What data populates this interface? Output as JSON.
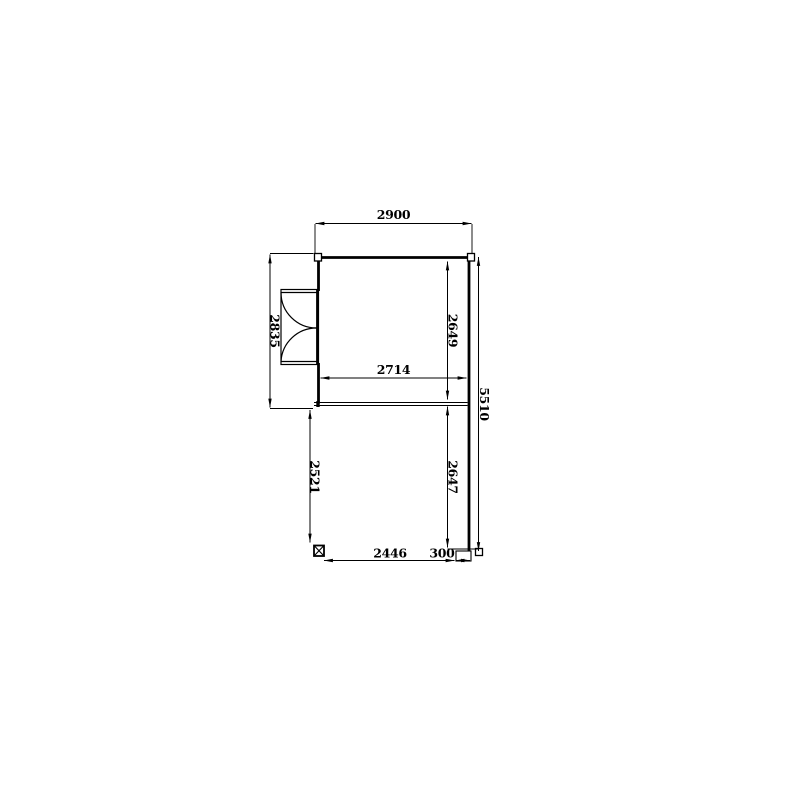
{
  "floor_plan": {
    "background": "#ffffff",
    "line_color": "#000000",
    "dims": {
      "top_width": "2900",
      "left_height": "2835",
      "room_inner_height": "2649",
      "room_inner_width": "2714",
      "total_right_height": "5510",
      "terrace_left_height": "2521",
      "terrace_inner_height": "2647",
      "bottom_width": "2446",
      "bottom_step_width": "300"
    }
  }
}
